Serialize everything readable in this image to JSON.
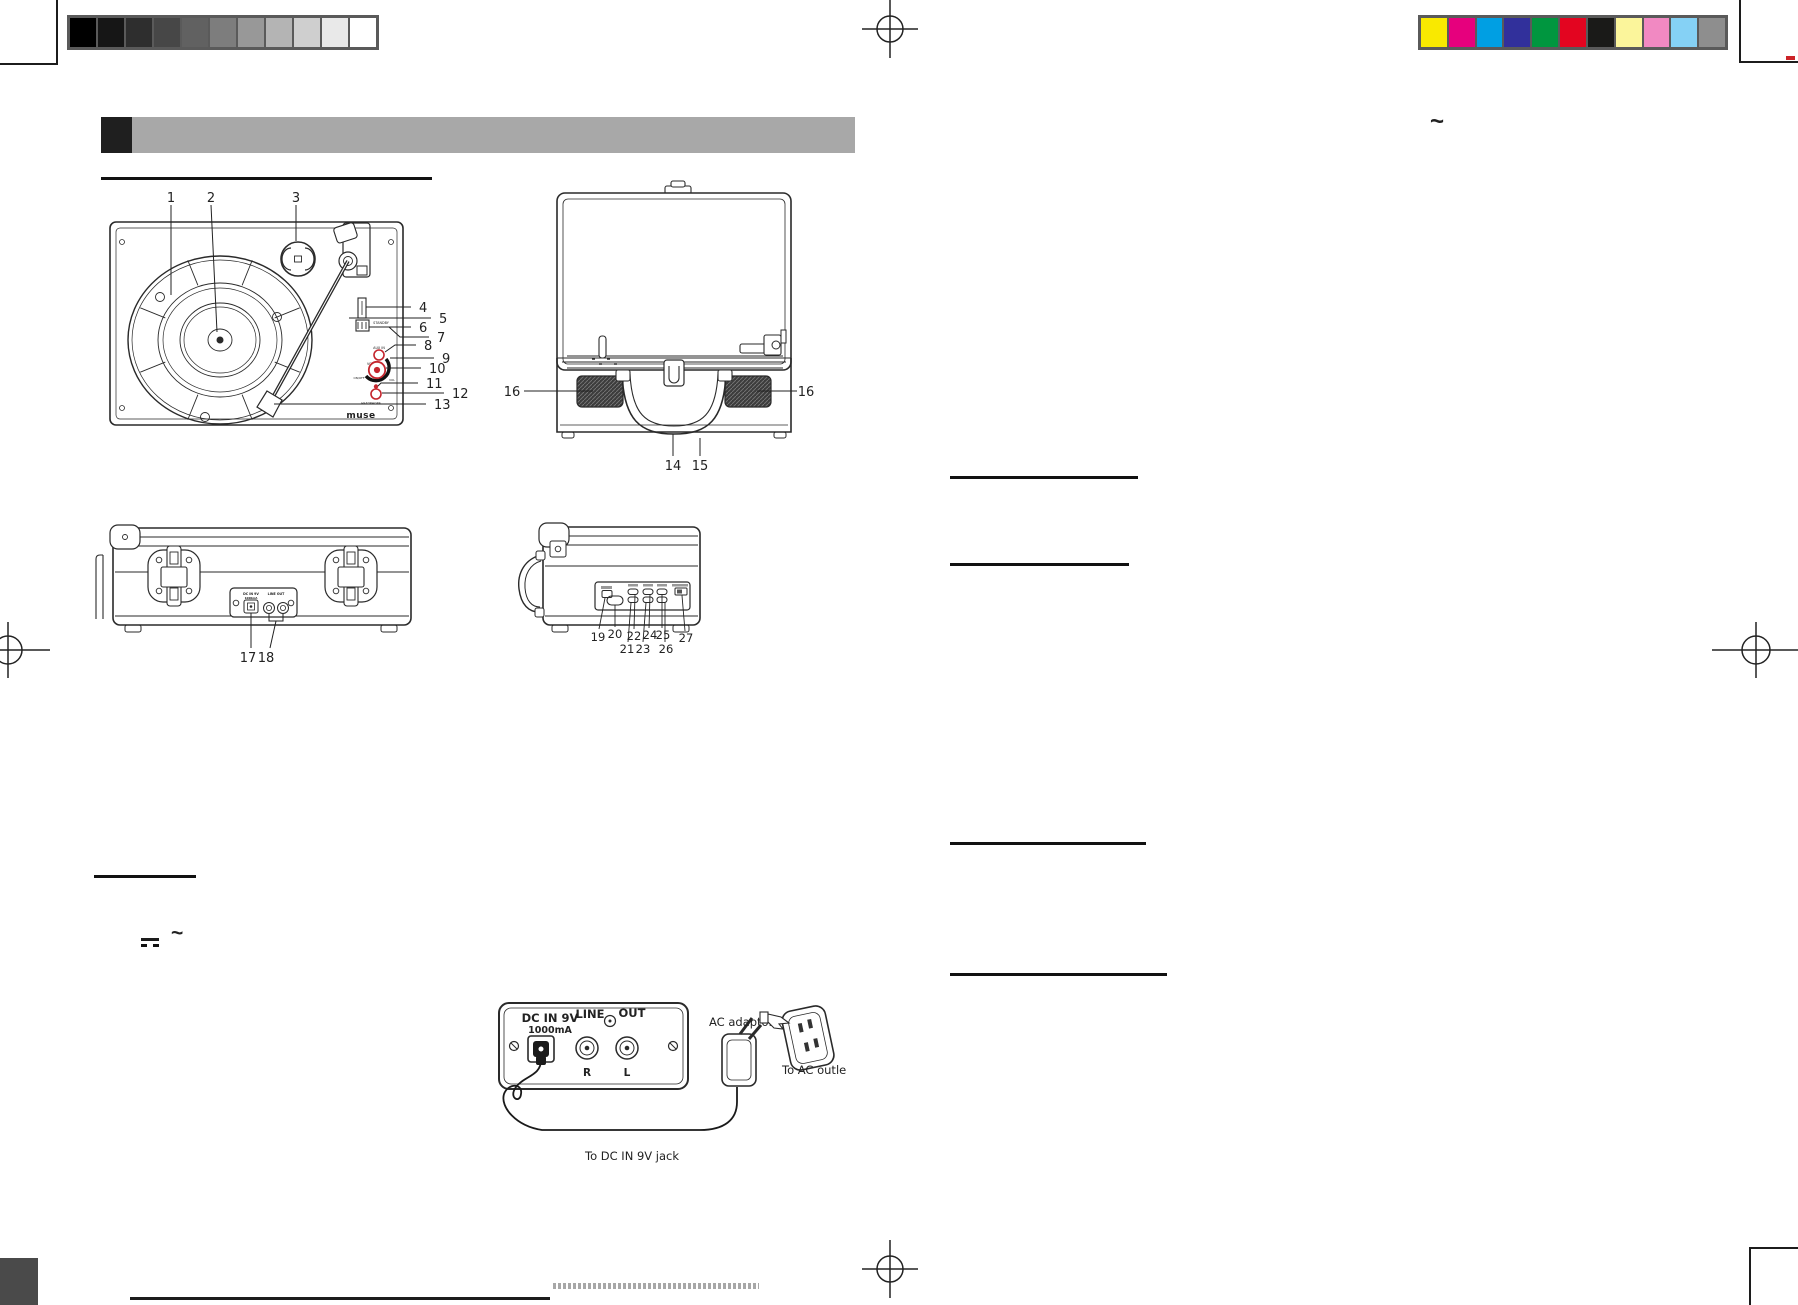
{
  "calibration": {
    "grayscale": [
      "#000000",
      "#161616",
      "#2e2e2e",
      "#474747",
      "#616161",
      "#7d7d7d",
      "#989898",
      "#b4b4b4",
      "#cfcfcf",
      "#e9e9e9",
      "#ffffff"
    ],
    "colors": [
      "#f9e900",
      "#e6007d",
      "#009fe3",
      "#31309b",
      "#00963f",
      "#e30520",
      "#1a1a18",
      "#fbf59b",
      "#f189c2",
      "#85d1f5",
      "#8e8e8e"
    ]
  },
  "header": {
    "accent_block": "#1f1f1f",
    "bar": "#a8a8a8"
  },
  "symbols": {
    "ac_right": "~",
    "ac_left": "~"
  },
  "diagrams": {
    "top_view": {
      "callouts": [
        "1",
        "2",
        "3",
        "4",
        "5",
        "6",
        "7",
        "8",
        "9",
        "10",
        "11",
        "12",
        "13"
      ],
      "labels": {
        "standby": "STANDBY",
        "aux_in": "AUX IN",
        "vol": "VOL.",
        "on_off": "ON/OFF",
        "vol_max": "VOL",
        "headphone": "HEADPHONE",
        "logo": "muse"
      }
    },
    "front_view": {
      "callouts": [
        "14",
        "15"
      ],
      "speaker_callout": "16"
    },
    "rear_view": {
      "callouts": [
        "17",
        "18"
      ],
      "panel": {
        "title1": "DC IN 9V",
        "title2": "1000mA",
        "title3": "LINE OUT"
      }
    },
    "side_view": {
      "callouts": [
        "19",
        "20",
        "21",
        "22",
        "23",
        "24",
        "25",
        "26",
        "27"
      ]
    }
  },
  "power_diagram": {
    "dc_in": "DC IN 9V",
    "current": "1000mA",
    "line": "LINE",
    "out": "OUT",
    "right": "R",
    "left": "L",
    "adaptor_label": "AC adaptor",
    "outlet_label": "To AC outle",
    "jack_label": "To DC IN 9V jack"
  }
}
